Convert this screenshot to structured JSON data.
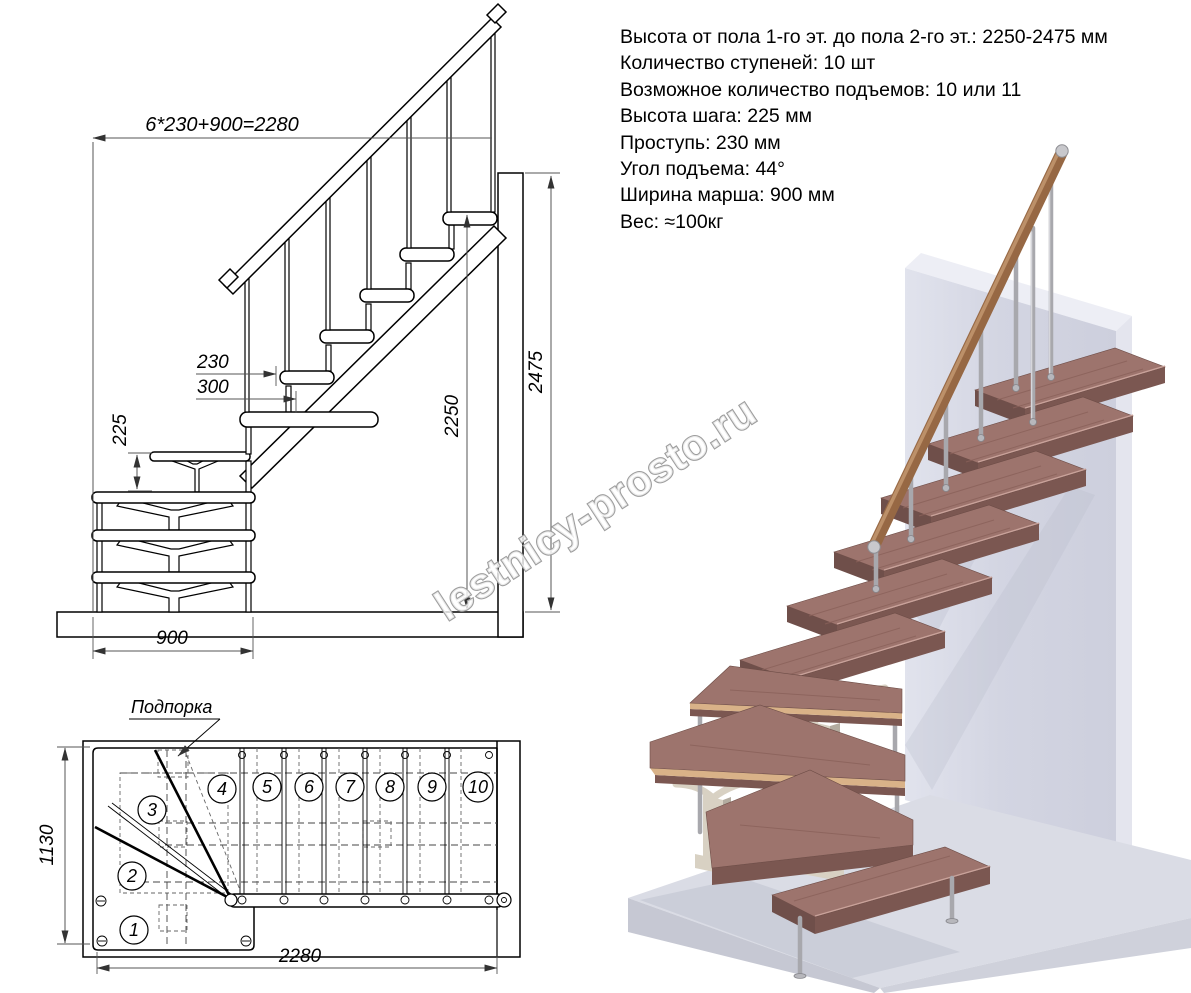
{
  "specs": {
    "lines": [
      "Высота от пола 1-го эт. до пола 2-го эт.: 2250-2475 мм",
      "Количество ступеней: 10 шт",
      "Возможное количество подъемов: 10 или 11",
      "Высота шага: 225 мм",
      "Проступь: 230 мм",
      "Угол подъема: 44°",
      "Ширина марша: 900 мм",
      "Вес: ≈100кг"
    ]
  },
  "elevation": {
    "dims": {
      "total_run": "6*230+900=2280",
      "tread_depth": "230",
      "tread_overlap": "300",
      "step_rise": "225",
      "clear_height": "2250",
      "total_height": "2475",
      "march_width": "900"
    }
  },
  "plan": {
    "support_label": "Подпорка",
    "dims": {
      "width": "1130",
      "length": "2280"
    },
    "steps": [
      "1",
      "2",
      "3",
      "4",
      "5",
      "6",
      "7",
      "8",
      "9",
      "10"
    ]
  },
  "watermark": {
    "text": "lestnicy-prosto.ru"
  },
  "colors": {
    "wall": "#d3d5e2",
    "wall_top": "#edeef5",
    "wall_side": "#e4e5ee",
    "floor": "#dadce5",
    "floor_side": "#c6c8d3",
    "tread_top": "#9d746d",
    "tread_front": "#7b5751",
    "tread_end": "#6f4f4a",
    "handrail": "#8a5c3c",
    "metal": "#a8a8ad",
    "support": "#d8d1c3",
    "outline": "#000000",
    "dimension": "#555555"
  }
}
